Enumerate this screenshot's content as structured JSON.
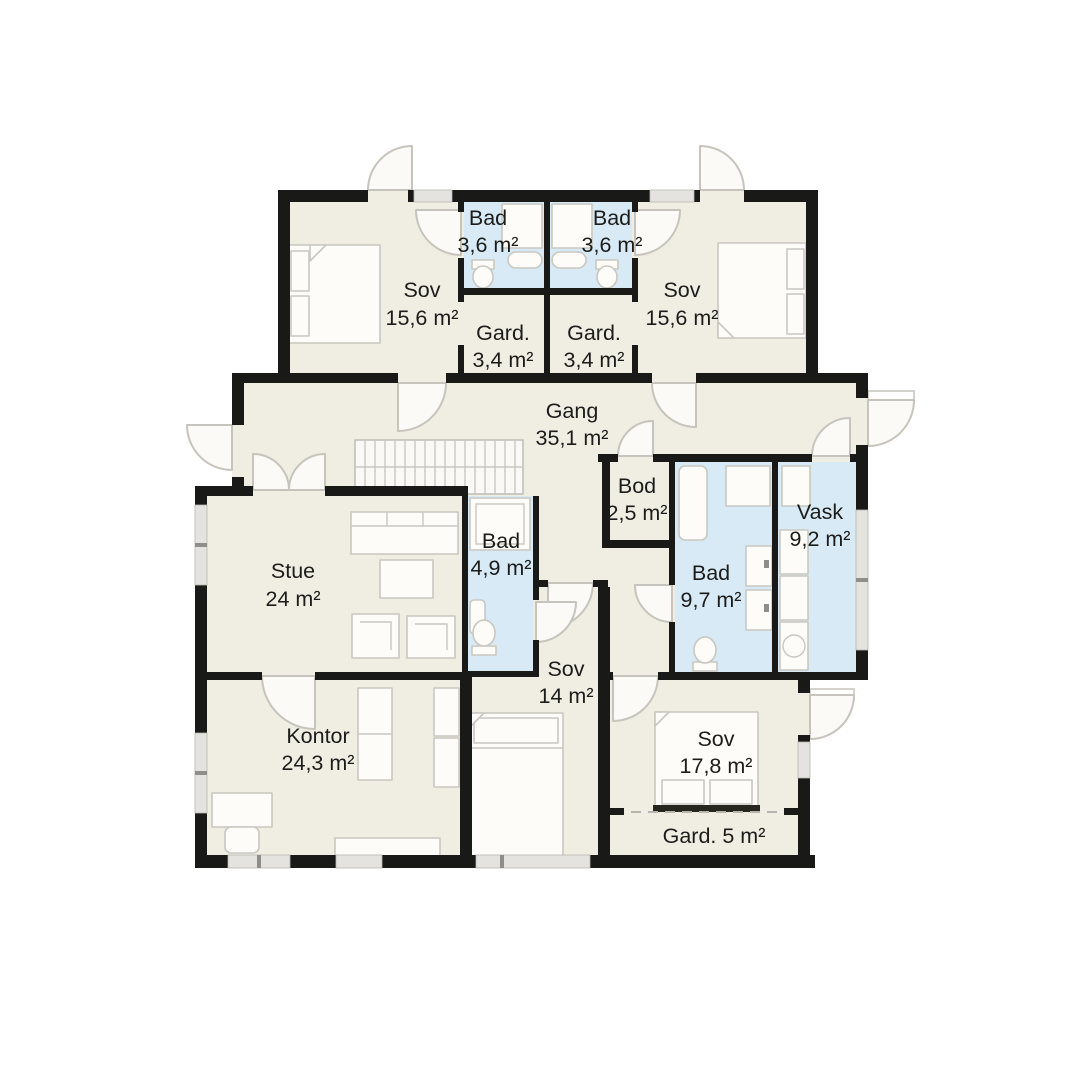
{
  "palette": {
    "background": "#ffffff",
    "floor": "#f0ede3",
    "wet_room": "#d8eaf5",
    "wall": "#191918"
  },
  "rooms": {
    "sov_nw": {
      "name": "Sov",
      "area": "15,6 m²"
    },
    "bad_nw": {
      "name": "Bad",
      "area": "3,6 m²"
    },
    "bad_ne": {
      "name": "Bad",
      "area": "3,6 m²"
    },
    "gard_w": {
      "name": "Gard.",
      "area": "3,4 m²"
    },
    "gard_e": {
      "name": "Gard.",
      "area": "3,4 m²"
    },
    "sov_ne": {
      "name": "Sov",
      "area": "15,6 m²"
    },
    "gang": {
      "name": "Gang",
      "area": "35,1 m²"
    },
    "bod": {
      "name": "Bod",
      "area": "2,5 m²"
    },
    "vask": {
      "name": "Vask",
      "area": "9,2 m²"
    },
    "bad_mid": {
      "name": "Bad",
      "area": "9,7 m²"
    },
    "bad_small": {
      "name": "Bad",
      "area": "4,9 m²"
    },
    "stue": {
      "name": "Stue",
      "area": "24 m²"
    },
    "sov_mid": {
      "name": "Sov",
      "area": "14 m²"
    },
    "kontor": {
      "name": "Kontor",
      "area": "24,3 m²"
    },
    "sov_se": {
      "name": "Sov",
      "area": "17,8 m²"
    },
    "gard_s": {
      "name": "Gard. 5 m²"
    }
  }
}
